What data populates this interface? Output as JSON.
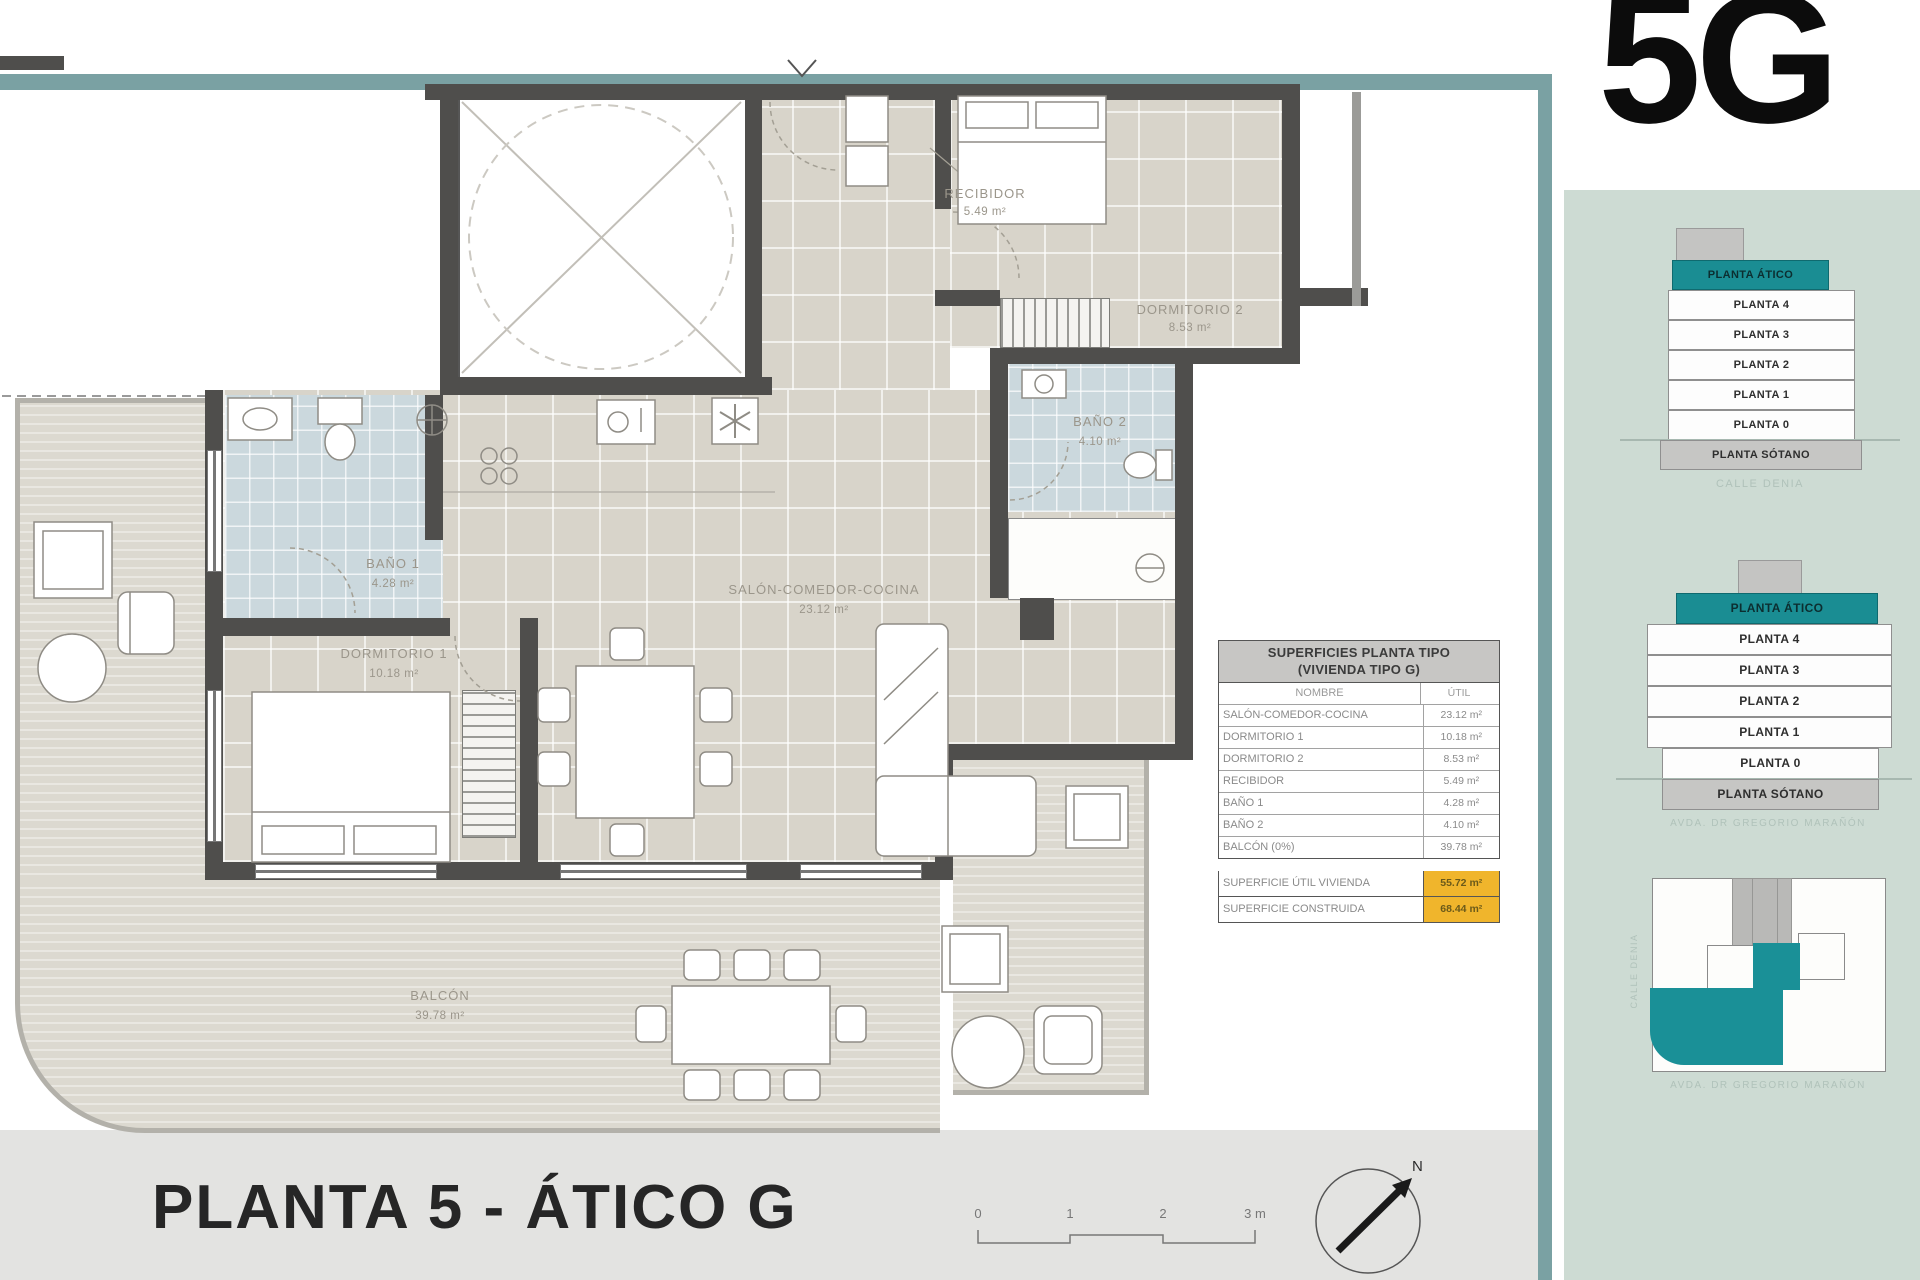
{
  "unit_code": "5G",
  "plan_title": "PLANTA 5 - ÁTICO G",
  "compass": {
    "north_label": "N"
  },
  "scale_bar": {
    "labels": [
      "0",
      "1",
      "2",
      "3 m"
    ]
  },
  "rooms": [
    {
      "name": "RECIBIDOR",
      "area": "5.49 m²"
    },
    {
      "name": "DORMITORIO 2",
      "area": "8.53 m²"
    },
    {
      "name": "BAÑO 2",
      "area": "4.10 m²"
    },
    {
      "name": "SALÓN-COMEDOR-COCINA",
      "area": "23.12 m²"
    },
    {
      "name": "BAÑO 1",
      "area": "4.28 m²"
    },
    {
      "name": "DORMITORIO 1",
      "area": "10.18 m²"
    },
    {
      "name": "BALCÓN",
      "area": "39.78 m²"
    }
  ],
  "areas_table": {
    "title_line1": "SUPERFICIES PLANTA TIPO",
    "title_line2": "(VIVIENDA TIPO G)",
    "col_name": "NOMBRE",
    "col_util": "ÚTIL",
    "rows": [
      {
        "name": "SALÓN-COMEDOR-COCINA",
        "util": "23.12 m²"
      },
      {
        "name": "DORMITORIO 1",
        "util": "10.18 m²"
      },
      {
        "name": "DORMITORIO 2",
        "util": "8.53 m²"
      },
      {
        "name": "RECIBIDOR",
        "util": "5.49 m²"
      },
      {
        "name": "BAÑO 1",
        "util": "4.28 m²"
      },
      {
        "name": "BAÑO 2",
        "util": "4.10 m²"
      },
      {
        "name": "BALCÓN (0%)",
        "util": "39.78 m²"
      }
    ],
    "totals": [
      {
        "name": "SUPERFICIE ÚTIL VIVIENDA",
        "value": "55.72 m²"
      },
      {
        "name": "SUPERFICIE CONSTRUIDA",
        "value": "68.44 m²"
      }
    ]
  },
  "sidebar": {
    "stack_small": {
      "levels": [
        "PLANTA ÁTICO",
        "PLANTA 4",
        "PLANTA 3",
        "PLANTA 2",
        "PLANTA 1",
        "PLANTA 0",
        "PLANTA SÓTANO"
      ],
      "street": "CALLE DENIA"
    },
    "stack_large": {
      "levels": [
        "PLANTA ÁTICO",
        "PLANTA 4",
        "PLANTA 3",
        "PLANTA 2",
        "PLANTA 1",
        "PLANTA 0",
        "PLANTA SÓTANO"
      ],
      "street": "AVDA. DR GREGORIO MARAÑÓN"
    },
    "site_plan": {
      "street_left": "CALLE DENIA",
      "street_bottom": "AVDA. DR GREGORIO MARAÑÓN"
    }
  },
  "colors": {
    "accent_teal": "#1a8d93",
    "bar_teal": "#7aa1a3",
    "sidebar_bg": "#cddbd3",
    "highlight_yellow": "#f0b52c"
  }
}
